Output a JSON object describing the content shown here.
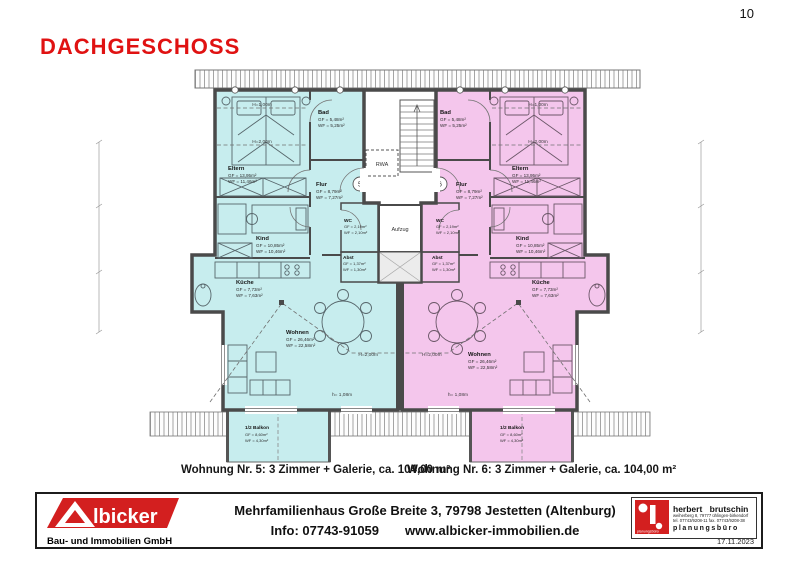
{
  "page": {
    "number": "10"
  },
  "title": "DACHGESCHOSS",
  "plan": {
    "colors": {
      "left_unit": "#c7edee",
      "right_unit": "#f4c6ec",
      "wall": "#4a4a4a",
      "accent_red": "#e01212"
    },
    "core": {
      "rwa": "RWA",
      "aufzug": "Aufzug",
      "unit_left": "5",
      "unit_right": "6"
    },
    "annot": {
      "h100": "H=1,00m",
      "h200": "H=2,00m",
      "h108": "h= 1,08m"
    },
    "rooms": {
      "eltern": {
        "name": "Eltern",
        "gf": "GF = 13,95m²",
        "wf": "WF = 11,46m²"
      },
      "bad": {
        "name": "Bad",
        "gf": "GF = 5,48m²",
        "wf": "WF = 5,25m²"
      },
      "flur": {
        "name": "Flur",
        "gf": "GF = 8,79m²",
        "wf": "WF = 7,27m²"
      },
      "kind": {
        "name": "Kind",
        "gf": "GF = 10,85m²",
        "wf": "WF = 10,46m²"
      },
      "wc": {
        "name": "WC",
        "gf": "GF = 2,19m²",
        "wf": "WF = 2,10m²"
      },
      "abst": {
        "name": "Abst",
        "gf": "GF = 1,37m²",
        "wf": "WF = 1,30m²"
      },
      "kueche": {
        "name": "Küche",
        "gf": "GF = 7,73m²",
        "wf": "WF = 7,63m²"
      },
      "wohnen": {
        "name": "Wohnen",
        "gf": "GF = 26,46m²",
        "wf": "WF = 22,58m²"
      },
      "balkon": {
        "name": "1/2 Balkon",
        "gf": "GF = 8,60m²",
        "wf": "WF = 4,30m²"
      }
    }
  },
  "captions": {
    "left": "Wohnung Nr. 5: 3 Zimmer + Galerie, ca. 104,00 m²",
    "right": "Wohnung Nr. 6: 3 Zimmer + Galerie, ca. 104,00 m²"
  },
  "footer": {
    "albicker": {
      "wordmark": "lbicker",
      "subtitle": "Bau- und Immobilien GmbH"
    },
    "line1": "Mehrfamilienhaus Große Breite 3, 79798 Jestetten (Altenburg)",
    "info": "Info: 07743-91059",
    "web": "www.albicker-immobilien.de",
    "architect": {
      "name": "herbert brutschin",
      "addr": "weiherberg 8, 79777 ühlingen-birkendorf",
      "tel": "tel. 07743/9208-11  fax. 07743/9208-38",
      "title": "planungsbüro",
      "badge": "planungsbüro",
      "date": "17.11.2023"
    }
  }
}
